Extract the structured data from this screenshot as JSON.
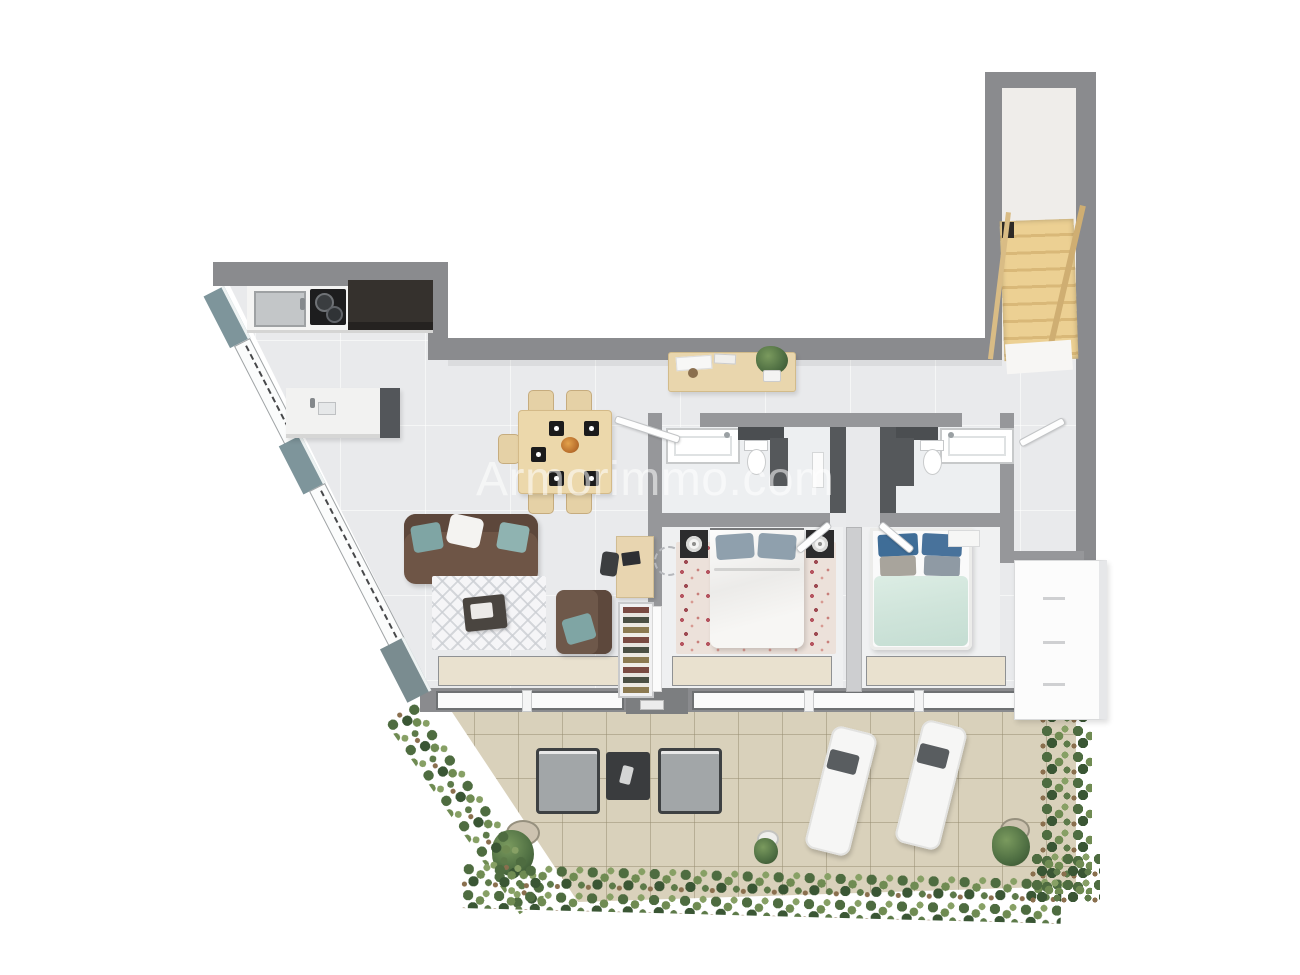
{
  "watermark": {
    "text": "Armorimmo.com",
    "color": "#ffffff",
    "opacity": "0.55"
  },
  "plan": {
    "type": "3d-floor-plan-top-view",
    "rooms": [
      {
        "name": "kitchen",
        "furniture": [
          "counter-with-sink",
          "gas-cooktop",
          "tall-dark-cabinet",
          "island-with-sink"
        ]
      },
      {
        "name": "dining-area",
        "furniture": [
          "square-wood-table",
          "five-chairs",
          "black-placemats",
          "centerpiece"
        ]
      },
      {
        "name": "living-room",
        "furniture": [
          "brown-sofa",
          "teal-cushions",
          "lattice-rug",
          "coffee-table",
          "armchair",
          "desk",
          "desk-chair",
          "shoe-rack"
        ]
      },
      {
        "name": "hallway",
        "furniture": [
          "console-table",
          "potted-plant",
          "entry-door"
        ]
      },
      {
        "name": "bathroom-1",
        "furniture": [
          "bathtub",
          "toilet",
          "dark-shower-partition",
          "shelf"
        ]
      },
      {
        "name": "bathroom-2",
        "furniture": [
          "bathtub",
          "toilet",
          "dark-shower-partition"
        ]
      },
      {
        "name": "bedroom-1",
        "furniture": [
          "double-bed-white-duvet",
          "floral-rug",
          "nightstand-left",
          "nightstand-right",
          "table-lamps"
        ]
      },
      {
        "name": "bedroom-2",
        "furniture": [
          "double-bed-mint-duvet",
          "blue-pillows",
          "white-bench",
          "white-dresser"
        ]
      },
      {
        "name": "stair-hall",
        "furniture": [
          "wooden-staircase",
          "handrails",
          "landing"
        ]
      },
      {
        "name": "terrace",
        "furniture": [
          "outdoor-chair-left",
          "outdoor-side-table",
          "outdoor-chair-right",
          "sun-lounger-left",
          "sun-lounger-right",
          "potted-plants",
          "hedge-borders"
        ]
      }
    ]
  },
  "palette": {
    "wall": "#8a8b8e",
    "wall_accent_teal": "#7e959b",
    "interior_wall": "#96979a",
    "floor": "#e9eaec",
    "bathroom_floor": "#edeff1",
    "terrace_tile": "#d9d1bb",
    "hedge_green": "#4e6c40",
    "wood_light": "#ecd8ab",
    "stair_wood": "#e5c583",
    "sofa_brown": "#6e5546",
    "cushion_teal": "#7fa5a4",
    "duvet_white": "#f1f0ee",
    "duvet_mint": "#cfe4da",
    "pillow_blue": "#3f6d97",
    "rug_floral_base": "#ece1da",
    "dark_furniture": "#35312d",
    "lounger_white": "#f6f6f5"
  }
}
